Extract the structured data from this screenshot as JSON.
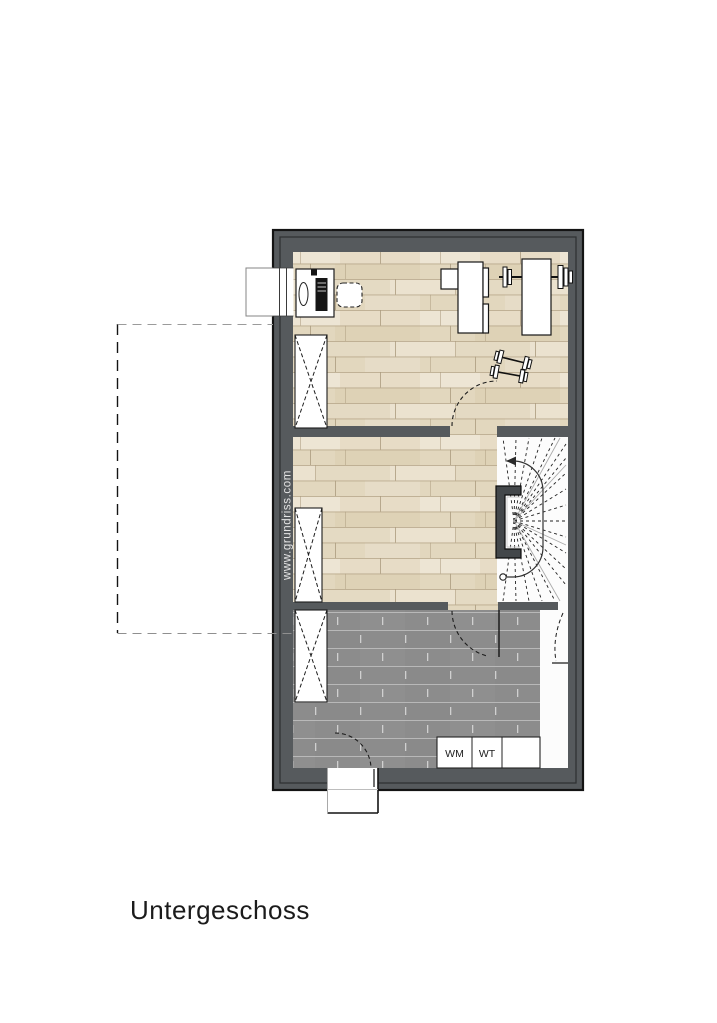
{
  "title": {
    "label": "Untergeschoss"
  },
  "watermark": {
    "label": "www.grundriss.com"
  },
  "bathroom": {
    "wm_label": "WM",
    "wt_label": "WT"
  },
  "colors": {
    "wall": "#565a5d",
    "wall_outline": "#141414",
    "wood_floor": "#e7ddc7",
    "tile_floor": "#8c8c8c",
    "stair_floor": "#fcfcfc",
    "line_dark": "#1c1c1c",
    "title_text": "#1b1b1b",
    "watermark_text": "#e4e4e4"
  }
}
